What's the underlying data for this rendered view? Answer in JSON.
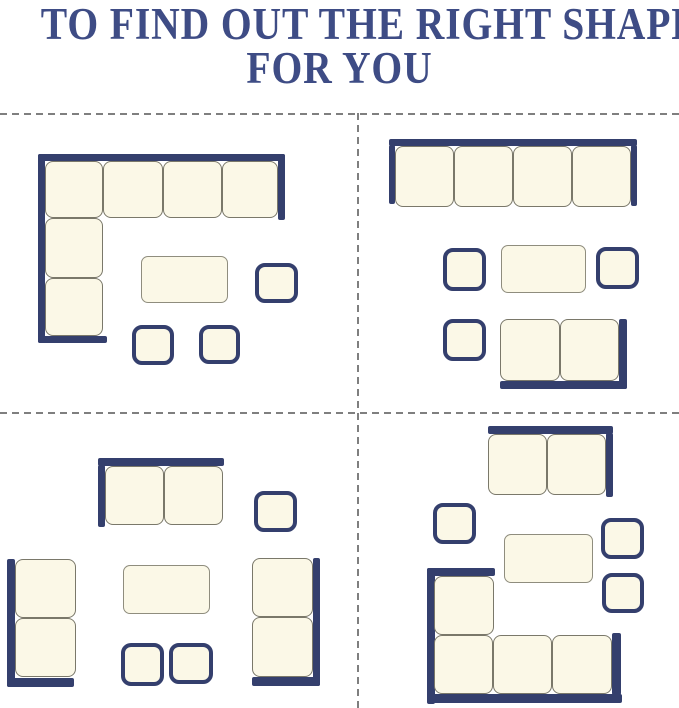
{
  "title": {
    "line1": "TO FIND OUT THE RIGHT SHAPE",
    "line2": "FOR YOU"
  },
  "colors": {
    "background": "#ffffff",
    "navy": "#343f6d",
    "title_text": "#3e4c85",
    "cream": "#fbf8e7",
    "seat_border": "#7a786a",
    "table_border": "#8f8d7e",
    "divider": "#7f7f7f"
  },
  "dividers": [
    {
      "dir": "h",
      "name": "divider-horizontal-top",
      "x": 0,
      "y": 113,
      "len": 679
    },
    {
      "dir": "h",
      "name": "divider-horizontal-middle",
      "x": 0,
      "y": 412,
      "len": 679
    },
    {
      "dir": "v",
      "name": "divider-vertical-center",
      "x": 357,
      "y": 113,
      "len": 595
    }
  ],
  "layouts": [
    {
      "name": "layout-corner-sectional-set",
      "pieces": [
        {
          "kind": "bar",
          "name": "sofa-back-top-bar",
          "x": 38,
          "y": 154,
          "w": 247,
          "h": 7
        },
        {
          "kind": "bar",
          "name": "sofa-back-left-bar",
          "x": 38,
          "y": 154,
          "w": 7,
          "h": 189
        },
        {
          "kind": "bar",
          "name": "sofa-arm-right-bar",
          "x": 278,
          "y": 154,
          "w": 7,
          "h": 66
        },
        {
          "kind": "bar",
          "name": "sofa-arm-bottom-bar",
          "x": 38,
          "y": 336,
          "w": 69,
          "h": 7
        },
        {
          "kind": "seat",
          "name": "corner-seat",
          "x": 45,
          "y": 161,
          "w": 58,
          "h": 57
        },
        {
          "kind": "seat",
          "name": "sofa-seat",
          "x": 103,
          "y": 161,
          "w": 60,
          "h": 57
        },
        {
          "kind": "seat",
          "name": "sofa-seat",
          "x": 163,
          "y": 161,
          "w": 59,
          "h": 57
        },
        {
          "kind": "seat",
          "name": "sofa-seat",
          "x": 222,
          "y": 161,
          "w": 56,
          "h": 57
        },
        {
          "kind": "seat",
          "name": "sofa-seat",
          "x": 45,
          "y": 218,
          "w": 58,
          "h": 60
        },
        {
          "kind": "seat",
          "name": "sofa-seat",
          "x": 45,
          "y": 278,
          "w": 58,
          "h": 58
        },
        {
          "kind": "table",
          "name": "coffee-table",
          "x": 141,
          "y": 256,
          "w": 87,
          "h": 47
        },
        {
          "kind": "ottoman",
          "name": "ottoman",
          "x": 255,
          "y": 263,
          "w": 43,
          "h": 40
        },
        {
          "kind": "ottoman",
          "name": "ottoman",
          "x": 132,
          "y": 325,
          "w": 42,
          "h": 40
        },
        {
          "kind": "ottoman",
          "name": "ottoman",
          "x": 199,
          "y": 325,
          "w": 41,
          "h": 39
        }
      ]
    },
    {
      "name": "layout-sofa-with-loveseat-set",
      "pieces": [
        {
          "kind": "bar",
          "name": "sofa-back-top-bar",
          "x": 389,
          "y": 139,
          "w": 248,
          "h": 7
        },
        {
          "kind": "bar",
          "name": "sofa-arm-left-bar",
          "x": 389,
          "y": 145,
          "w": 6,
          "h": 59
        },
        {
          "kind": "bar",
          "name": "sofa-arm-right-bar",
          "x": 631,
          "y": 145,
          "w": 6,
          "h": 61
        },
        {
          "kind": "seat",
          "name": "sofa-seat",
          "x": 395,
          "y": 146,
          "w": 59,
          "h": 61
        },
        {
          "kind": "seat",
          "name": "sofa-seat",
          "x": 454,
          "y": 146,
          "w": 59,
          "h": 61
        },
        {
          "kind": "seat",
          "name": "sofa-seat",
          "x": 513,
          "y": 146,
          "w": 59,
          "h": 61
        },
        {
          "kind": "seat",
          "name": "sofa-seat",
          "x": 572,
          "y": 146,
          "w": 59,
          "h": 61
        },
        {
          "kind": "ottoman",
          "name": "side-table",
          "x": 443,
          "y": 248,
          "w": 43,
          "h": 43
        },
        {
          "kind": "table",
          "name": "coffee-table",
          "x": 501,
          "y": 245,
          "w": 85,
          "h": 48
        },
        {
          "kind": "ottoman",
          "name": "side-table",
          "x": 596,
          "y": 247,
          "w": 43,
          "h": 42
        },
        {
          "kind": "ottoman",
          "name": "ottoman",
          "x": 443,
          "y": 319,
          "w": 43,
          "h": 42
        },
        {
          "kind": "seat",
          "name": "loveseat-seat",
          "x": 500,
          "y": 319,
          "w": 60,
          "h": 62
        },
        {
          "kind": "seat",
          "name": "loveseat-seat",
          "x": 560,
          "y": 319,
          "w": 59,
          "h": 62
        },
        {
          "kind": "bar",
          "name": "loveseat-back-bottom-bar",
          "x": 500,
          "y": 381,
          "w": 127,
          "h": 8
        },
        {
          "kind": "bar",
          "name": "loveseat-arm-right-bar",
          "x": 619,
          "y": 319,
          "w": 8,
          "h": 70
        }
      ]
    },
    {
      "name": "layout-loveseat-armchairs-set",
      "pieces": [
        {
          "kind": "bar",
          "name": "loveseat-back-top-bar",
          "x": 98,
          "y": 458,
          "w": 126,
          "h": 8
        },
        {
          "kind": "bar",
          "name": "loveseat-arm-left-bar",
          "x": 98,
          "y": 465,
          "w": 7,
          "h": 62
        },
        {
          "kind": "seat",
          "name": "loveseat-seat",
          "x": 105,
          "y": 466,
          "w": 59,
          "h": 59
        },
        {
          "kind": "seat",
          "name": "loveseat-seat",
          "x": 164,
          "y": 466,
          "w": 59,
          "h": 59
        },
        {
          "kind": "ottoman",
          "name": "ottoman",
          "x": 254,
          "y": 491,
          "w": 43,
          "h": 41
        },
        {
          "kind": "bar",
          "name": "loveseat-back-left-bar",
          "x": 7,
          "y": 559,
          "w": 8,
          "h": 128
        },
        {
          "kind": "bar",
          "name": "loveseat-arm-bottom-bar",
          "x": 7,
          "y": 678,
          "w": 67,
          "h": 9
        },
        {
          "kind": "seat",
          "name": "loveseat-seat",
          "x": 15,
          "y": 559,
          "w": 61,
          "h": 59
        },
        {
          "kind": "seat",
          "name": "loveseat-seat",
          "x": 15,
          "y": 618,
          "w": 61,
          "h": 59
        },
        {
          "kind": "table",
          "name": "coffee-table",
          "x": 123,
          "y": 565,
          "w": 87,
          "h": 49
        },
        {
          "kind": "ottoman",
          "name": "ottoman",
          "x": 121,
          "y": 643,
          "w": 43,
          "h": 43
        },
        {
          "kind": "ottoman",
          "name": "ottoman",
          "x": 169,
          "y": 643,
          "w": 44,
          "h": 41
        },
        {
          "kind": "bar",
          "name": "loveseat-back-right-bar",
          "x": 313,
          "y": 558,
          "w": 7,
          "h": 128
        },
        {
          "kind": "bar",
          "name": "loveseat-arm-bottom-bar",
          "x": 252,
          "y": 677,
          "w": 68,
          "h": 9
        },
        {
          "kind": "seat",
          "name": "loveseat-seat",
          "x": 252,
          "y": 558,
          "w": 61,
          "h": 59
        },
        {
          "kind": "seat",
          "name": "loveseat-seat",
          "x": 252,
          "y": 617,
          "w": 61,
          "h": 60
        }
      ]
    },
    {
      "name": "layout-sectional-with-loveseat-set",
      "pieces": [
        {
          "kind": "bar",
          "name": "loveseat-back-top-bar",
          "x": 488,
          "y": 426,
          "w": 125,
          "h": 8
        },
        {
          "kind": "bar",
          "name": "loveseat-arm-right-bar",
          "x": 606,
          "y": 433,
          "w": 7,
          "h": 64
        },
        {
          "kind": "seat",
          "name": "loveseat-seat",
          "x": 488,
          "y": 434,
          "w": 59,
          "h": 61
        },
        {
          "kind": "seat",
          "name": "loveseat-seat",
          "x": 547,
          "y": 434,
          "w": 59,
          "h": 61
        },
        {
          "kind": "ottoman",
          "name": "ottoman",
          "x": 433,
          "y": 503,
          "w": 43,
          "h": 41
        },
        {
          "kind": "table",
          "name": "coffee-table",
          "x": 504,
          "y": 534,
          "w": 89,
          "h": 49
        },
        {
          "kind": "ottoman",
          "name": "side-table",
          "x": 601,
          "y": 518,
          "w": 43,
          "h": 41
        },
        {
          "kind": "ottoman",
          "name": "side-table",
          "x": 602,
          "y": 573,
          "w": 42,
          "h": 40
        },
        {
          "kind": "bar",
          "name": "sectional-back-top-bar",
          "x": 427,
          "y": 568,
          "w": 68,
          "h": 8
        },
        {
          "kind": "bar",
          "name": "sectional-back-left-bar",
          "x": 427,
          "y": 568,
          "w": 8,
          "h": 136
        },
        {
          "kind": "bar",
          "name": "sectional-back-bottom-bar",
          "x": 427,
          "y": 694,
          "w": 195,
          "h": 9
        },
        {
          "kind": "bar",
          "name": "sectional-arm-right-bar",
          "x": 612,
          "y": 633,
          "w": 9,
          "h": 62
        },
        {
          "kind": "seat",
          "name": "sofa-seat",
          "x": 434,
          "y": 576,
          "w": 60,
          "h": 59
        },
        {
          "kind": "seat",
          "name": "sofa-seat",
          "x": 434,
          "y": 635,
          "w": 59,
          "h": 59
        },
        {
          "kind": "seat",
          "name": "sofa-seat",
          "x": 493,
          "y": 635,
          "w": 59,
          "h": 59
        },
        {
          "kind": "seat",
          "name": "sofa-seat",
          "x": 552,
          "y": 635,
          "w": 60,
          "h": 59
        }
      ]
    }
  ]
}
